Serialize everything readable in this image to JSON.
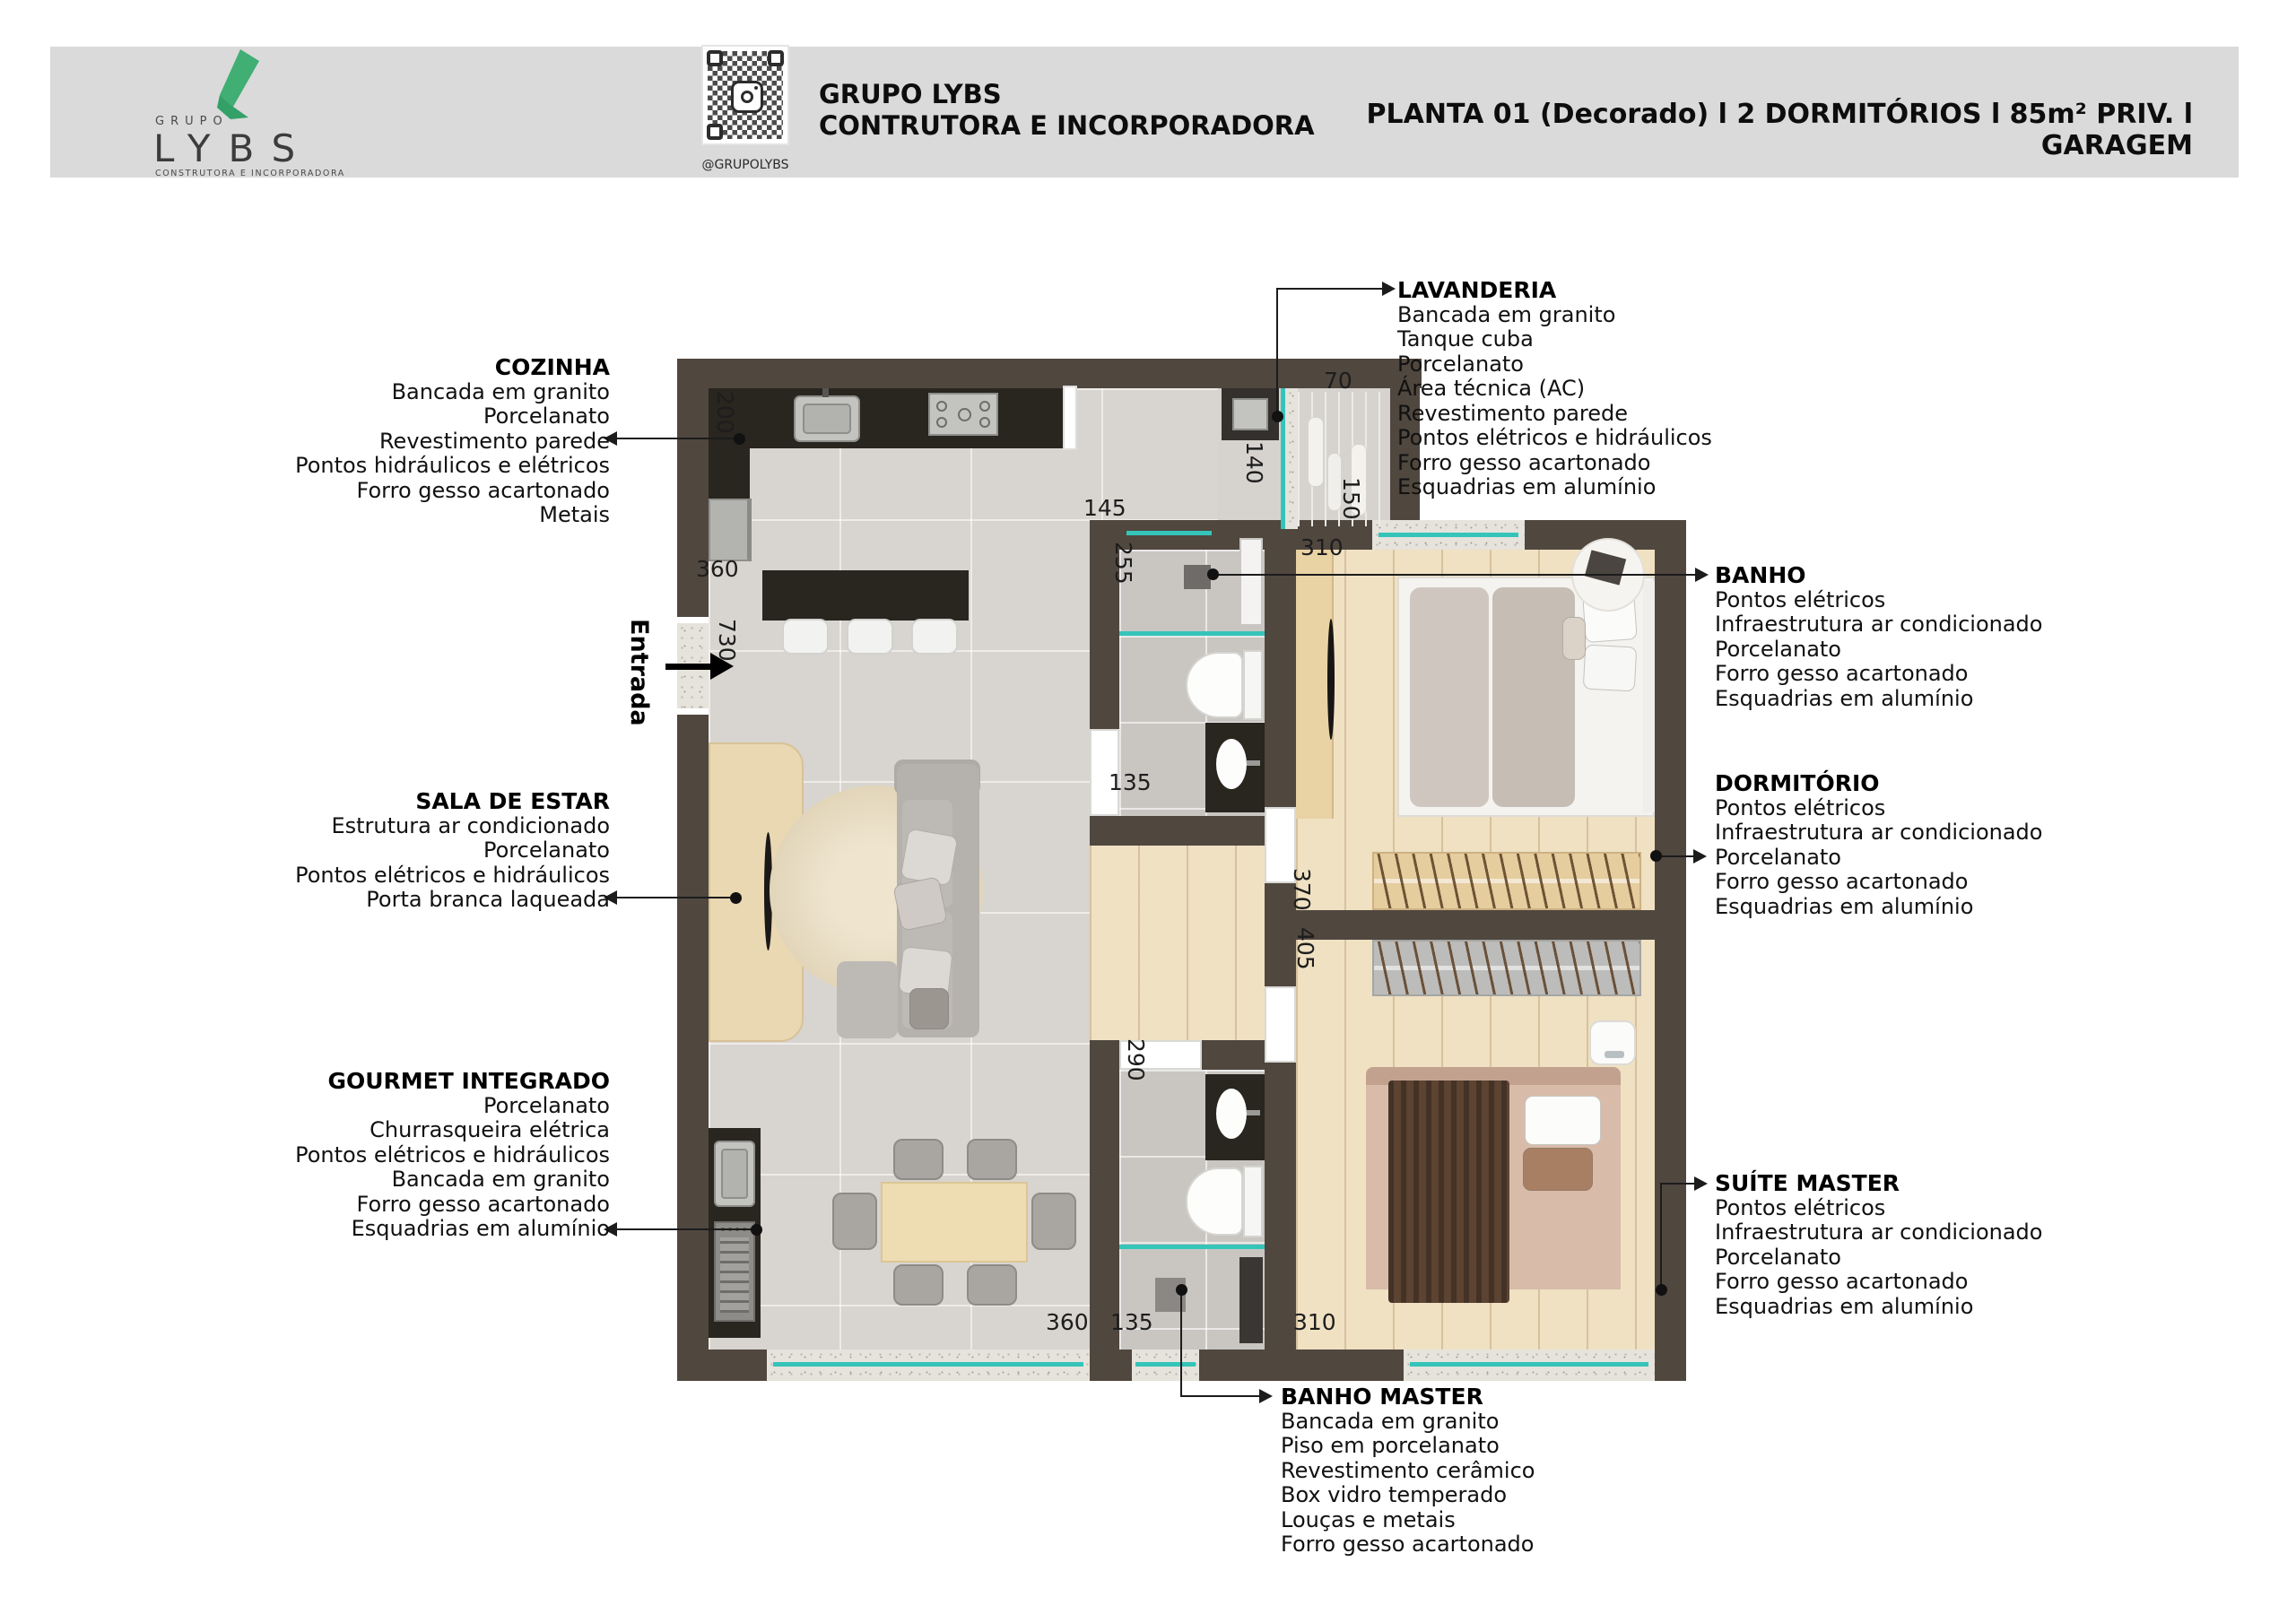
{
  "header": {
    "logo": {
      "top": "GRUPO",
      "name": "LYBS",
      "subtitle": "CONSTRUTORA E INCORPORADORA"
    },
    "qr_caption": "@GRUPOLYBS",
    "company": {
      "line1": "GRUPO LYBS",
      "line2": "CONTRUTORA E INCORPORADORA"
    },
    "title": "PLANTA 01 (Decorado) l 2 DORMITÓRIOS l 85m² PRIV. l GARAGEM"
  },
  "annotations": {
    "cozinha": {
      "title": "COZINHA",
      "items": [
        "Bancada em granito",
        "Porcelanato",
        "Revestimento parede",
        "Pontos hidráulicos e elétricos",
        "Forro gesso acartonado",
        "Metais"
      ]
    },
    "sala_de_estar": {
      "title": "SALA DE ESTAR",
      "items": [
        "Estrutura ar condicionado",
        "Porcelanato",
        "Pontos elétricos e hidráulicos",
        "Porta branca laqueada"
      ]
    },
    "gourmet_integrado": {
      "title": "GOURMET INTEGRADO",
      "items": [
        "Porcelanato",
        "Churrasqueira elétrica",
        "Pontos elétricos e hidráulicos",
        "Bancada em granito",
        "Forro gesso acartonado",
        "Esquadrias em alumínio"
      ]
    },
    "lavanderia": {
      "title": "LAVANDERIA",
      "items": [
        "Bancada em granito",
        "Tanque cuba",
        "Porcelanato",
        "Área técnica (AC)",
        "Revestimento parede",
        "Pontos elétricos e hidráulicos",
        "Forro gesso acartonado",
        "Esquadrias em alumínio"
      ]
    },
    "banho": {
      "title": "BANHO",
      "items": [
        "Pontos elétricos",
        "Infraestrutura ar condicionado",
        "Porcelanato",
        "Forro gesso acartonado",
        "Esquadrias em alumínio"
      ]
    },
    "dormitorio": {
      "title": "DORMITÓRIO",
      "items": [
        "Pontos elétricos",
        "Infraestrutura ar condicionado",
        "Porcelanato",
        "Forro gesso acartonado",
        "Esquadrias em alumínio"
      ]
    },
    "suite_master": {
      "title": "SUÍTE MASTER",
      "items": [
        "Pontos elétricos",
        "Infraestrutura ar condicionado",
        "Porcelanato",
        "Forro gesso acartonado",
        "Esquadrias em alumínio"
      ]
    },
    "banho_master": {
      "title": "BANHO MASTER",
      "items": [
        "Bancada em granito",
        "Piso em porcelanato",
        "Revestimento cerâmico",
        "Box vidro temperado",
        "Louças e metais",
        "Forro gesso acartonado"
      ]
    }
  },
  "plan": {
    "entrance_label": "Entrada",
    "dimensions": {
      "cozinha_depth": "200",
      "cozinha_width": "360",
      "entrada_span": "730",
      "hall_top": "145",
      "banho_depth": "255",
      "lav_width": "140",
      "lav_top": "70",
      "lav_right": "150",
      "dormitorio_width": "310",
      "banho_door": "135",
      "dorm_depth": "370",
      "suite_depth": "405",
      "banho_master_depth": "290",
      "gourmet_window": "360",
      "banho_master_width": "135",
      "suite_width": "310"
    }
  },
  "colors": {
    "brand_green": "#41ae74",
    "header_gray": "#dadada",
    "wall": "#50473f",
    "counter_granite": "#29251f",
    "glass_teal": "#35c4ba"
  }
}
